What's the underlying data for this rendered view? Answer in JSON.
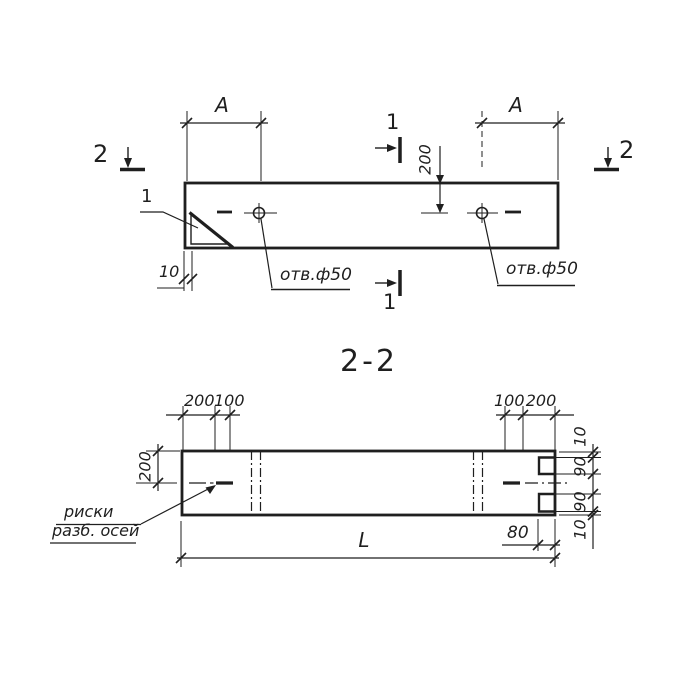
{
  "colors": {
    "ink": "#1f1f1f",
    "paper": "#ffffff"
  },
  "plan_view": {
    "section_mark_left": "2",
    "section_mark_right": "2",
    "section_mark_top": "1",
    "section_mark_bottom": "1",
    "detail_ref": "1",
    "dim_a_left": "A",
    "dim_a_right": "A",
    "dim_edge_to_axis": "200",
    "dim_chamfer": "10",
    "hole_label_left": "отв.ф50",
    "hole_label_right": "отв.ф50"
  },
  "section_title": "2-2",
  "section_view": {
    "dim_top_left_1": "200",
    "dim_top_left_2": "100",
    "dim_top_right_1": "100",
    "dim_top_right_2": "200",
    "dim_edge_to_axis": "200",
    "dim_right_1": "10",
    "dim_right_2": "90",
    "dim_right_3": "90",
    "dim_right_4": "10",
    "dim_notch_depth": "80",
    "dim_length": "L",
    "axis_label_line1": "риски",
    "axis_label_line2": "разб. осей"
  }
}
